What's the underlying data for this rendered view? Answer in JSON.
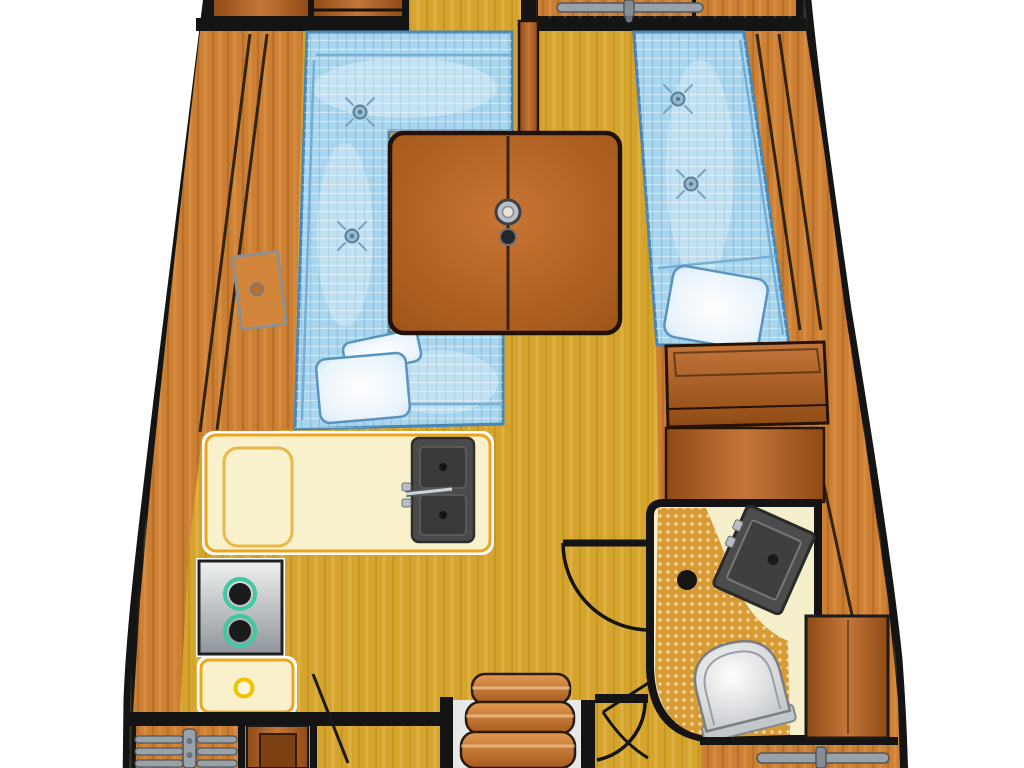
{
  "canvas": {
    "width": 1024,
    "height": 768
  },
  "scene": {
    "type": "floor-plan-diagram",
    "subject": "Sailboat interior layout (top-down): saloon dinette, drop-leaf table, starboard settee berth, galley with sink and stove, head with toilet and corner sink, companionway steps"
  },
  "colors": {
    "page_bg": "#ffffff",
    "outline": "#141414",
    "wood_mid": "#cd7f33",
    "wood_light": "#e09a4e",
    "wood_dark": "#a8611f",
    "door_light": "#c4763a",
    "door_dark": "#8f4a14",
    "floor": "#d5a42c",
    "cushion": "#a9d6ee",
    "cushion_border": "#4886b5",
    "cushion_seam": "#74aed6",
    "pillow_edge": "#c9e2f2",
    "counter": "#f8f1cc",
    "counter_border": "#eca51d",
    "steel": "#9aa1a9",
    "steel_dark": "#50565c",
    "sink": "#4a4a4a",
    "sink_basin": "#3a3a3a",
    "burner_ring": "#3fc9a2",
    "burner": "#1b1b1b",
    "grate": "#d89a35",
    "grate_dot": "#f2d9a0",
    "head_floor": "#f6efcb",
    "toilet_ring": "#c2c7cc",
    "table_light": "#c97433",
    "table_dark": "#9c5317",
    "knob_ring": "#f2c200"
  },
  "objects": [
    {
      "id": "hull",
      "label": "hull outline"
    },
    {
      "id": "fwd-bulkhead",
      "label": "forward bulkhead with doorway"
    },
    {
      "id": "fwd-cabinets",
      "label": "forward cabinets"
    },
    {
      "id": "fwd-hatch-handle",
      "label": "forward hatch handle"
    },
    {
      "id": "port-shelf",
      "label": "port hull shelf"
    },
    {
      "id": "port-locker",
      "label": "port locker door"
    },
    {
      "id": "dinette-settee",
      "label": "U-shaped dinette settee"
    },
    {
      "id": "dinette-pillows",
      "label": "dinette pillows"
    },
    {
      "id": "tuft-buttons",
      "label": "cushion tuft buttons"
    },
    {
      "id": "saloon-table",
      "label": "drop-leaf saloon table"
    },
    {
      "id": "table-hub",
      "label": "table pedestal hub"
    },
    {
      "id": "mast-post",
      "label": "bulkhead post"
    },
    {
      "id": "stbd-settee",
      "label": "starboard settee berth"
    },
    {
      "id": "stbd-pillow",
      "label": "starboard pillow"
    },
    {
      "id": "stbd-cabinet",
      "label": "starboard aft cabinet"
    },
    {
      "id": "quarter-panel",
      "label": "quarter berth panel"
    },
    {
      "id": "galley-counter",
      "label": "galley counter"
    },
    {
      "id": "icebox-lid",
      "label": "icebox lid"
    },
    {
      "id": "galley-sink",
      "label": "galley double sink with faucet"
    },
    {
      "id": "galley-stove",
      "label": "two-burner stove"
    },
    {
      "id": "galley-drawer",
      "label": "galley drawer"
    },
    {
      "id": "head-compartment",
      "label": "head compartment"
    },
    {
      "id": "head-grate",
      "label": "teak grate shower floor"
    },
    {
      "id": "head-sink",
      "label": "head corner sink"
    },
    {
      "id": "head-drain",
      "label": "shower drain"
    },
    {
      "id": "toilet",
      "label": "marine toilet"
    },
    {
      "id": "head-door",
      "label": "head door with swing arc"
    },
    {
      "id": "companionway-steps",
      "label": "companionway steps"
    },
    {
      "id": "engine-vent",
      "label": "engine compartment vent"
    },
    {
      "id": "aft-doors",
      "label": "aft cabin doors with swing lines"
    },
    {
      "id": "aft-hatch-handle",
      "label": "aft hatch handle"
    }
  ]
}
